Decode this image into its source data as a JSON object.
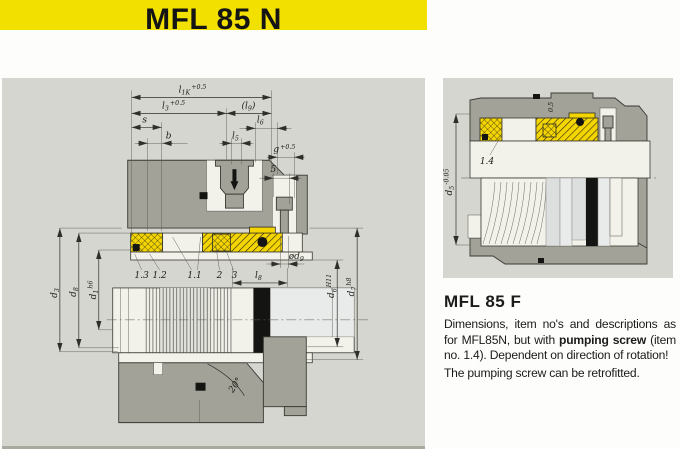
{
  "banner": {
    "title": "MFL 85 N"
  },
  "left_drawing": {
    "dims": {
      "l1k": {
        "base": "l",
        "sub": "1K",
        "tol": "+0.5"
      },
      "l3": {
        "base": "l",
        "sub": "3",
        "tol": "+0.5"
      },
      "l9": {
        "open": "(",
        "base": "l",
        "sub": "9",
        "close": ")"
      },
      "l6": {
        "base": "l",
        "sub": "6"
      },
      "l5": {
        "base": "l",
        "sub": "5"
      },
      "s": {
        "base": "s"
      },
      "b": {
        "base": "b"
      },
      "g": {
        "base": "g",
        "tol": "+0.5"
      },
      "five": {
        "base": "5"
      },
      "d3": {
        "base": "d",
        "sub": "3"
      },
      "d8": {
        "base": "d",
        "sub": "8"
      },
      "d1": {
        "base": "d",
        "sub": "1",
        "tol": "h6"
      },
      "od9": {
        "base": "ød",
        "sub": "9"
      },
      "l8": {
        "base": "l",
        "sub": "8"
      },
      "d6": {
        "base": "d",
        "sub": "6",
        "tol": "H11"
      },
      "d7": {
        "base": "d",
        "sub": "7",
        "tol": "h8"
      },
      "angle": {
        "base": "20°"
      }
    },
    "items": {
      "i13": "1.3",
      "i12": "1.2",
      "i11": "1.1",
      "i2": "2",
      "i3": "3"
    }
  },
  "right_drawing": {
    "dims": {
      "d5": {
        "base": "d",
        "sub": "5",
        "tol": "-0.05"
      },
      "half": {
        "base": "0.5"
      }
    },
    "items": {
      "i14": "1.4"
    }
  },
  "info": {
    "heading": "MFL 85 F",
    "para": {
      "t1": "Dimensions, item no's and descriptions as for MFL85N, but with ",
      "bold": "pumping screw",
      "t2": " (item no. 1.4). Dependent on direction of rotation!"
    },
    "line2": "The pumping screw can be retrofitted."
  },
  "colors": {
    "banner": "#f2e000",
    "panel": "#d6d6d0",
    "housing": "#a2a298",
    "yellow": "#f5d500",
    "white": "#f2f1ea"
  }
}
